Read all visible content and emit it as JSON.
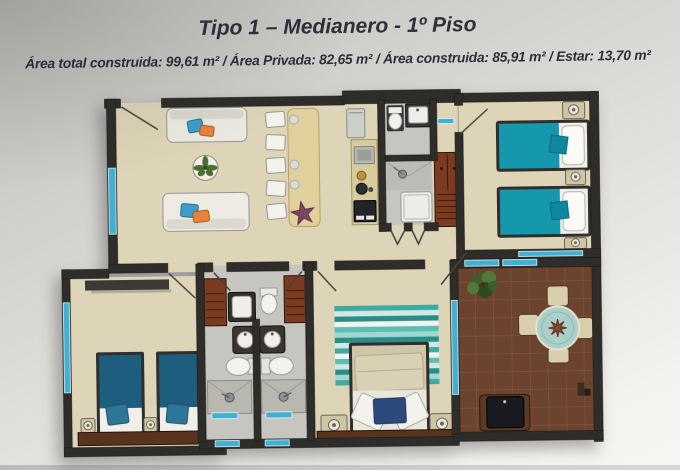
{
  "header": {
    "title": "Tipo 1 – Medianero - 1º Piso",
    "subtitle": "Área total construida: 99,61 m² / Área Privada: 82,65 m² / Área construida: 85,91 m² / Estar: 13,70 m²"
  },
  "plan": {
    "type": "apartment-floor-plan",
    "rooms": [
      "living-dining",
      "kitchen",
      "main-bathroom",
      "bedroom-two-teal-beds",
      "bedroom-two-blue-beds",
      "master-bedroom",
      "twin-bathrooms",
      "terrace-with-bbq"
    ]
  },
  "colors": {
    "wall": "#2e2d2a",
    "floor_beige": "#ded5b8",
    "floor_gray": "#c6c5bf",
    "terrace_brown": "#6b432e",
    "terrace_grout": "#8f5c3e",
    "bed_teal": "#1598ac",
    "bed_blue": "#1d5d7d",
    "window_cyan": "#41b0d2",
    "closet_rust": "#7c3a21",
    "wood_dark": "#58341f",
    "table_tan": "#e0d09b",
    "sofa_light": "#ebe9e2",
    "cushion_blue": "#3b9fc9",
    "cushion_orange": "#e8833c",
    "pillow_navy": "#2c4a7c",
    "rug_teal": "#3fa9a4",
    "glass_table": "#abcfc9",
    "chair_beige": "#d9cfad",
    "plant_green": "#4c6e35",
    "starfish_purple": "#7b4660",
    "text": "#32323a"
  }
}
